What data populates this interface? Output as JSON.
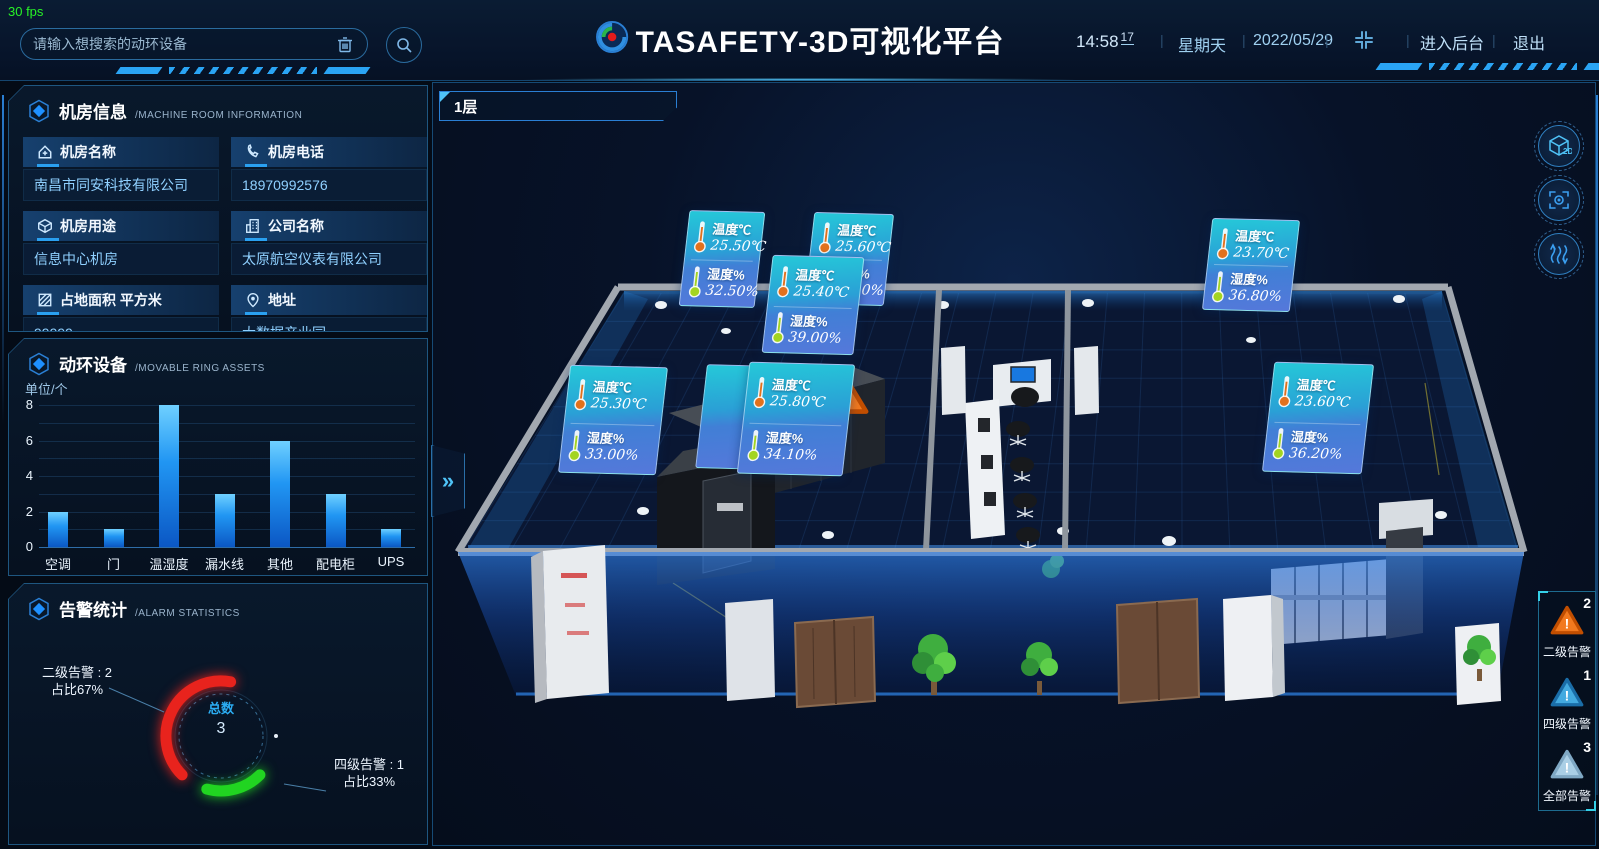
{
  "header": {
    "fps": "30 fps",
    "search": {
      "placeholder": "请输入想搜索的动环设备"
    },
    "title": "TASAFETY-3D可视化平台",
    "clock": {
      "time": "14:58",
      "seconds": "17",
      "weekday": "星期天",
      "date": "2022/05/29"
    },
    "actions": {
      "backend": "进入后台",
      "exit": "退出"
    }
  },
  "panels": {
    "room_info": {
      "title": "机房信息",
      "subtitle": "/MACHINE ROOM INFORMATION",
      "fields": [
        {
          "icon": "home-icon",
          "label": "机房名称",
          "value": "南昌市同安科技有限公司"
        },
        {
          "icon": "phone-icon",
          "label": "机房电话",
          "value": "18970992576"
        },
        {
          "icon": "cube-icon",
          "label": "机房用途",
          "value": "信息中心机房"
        },
        {
          "icon": "building-icon",
          "label": "公司名称",
          "value": "太原航空仪表有限公司"
        },
        {
          "icon": "area-icon",
          "label": "占地面积 平方米",
          "value": "99999"
        },
        {
          "icon": "pin-icon",
          "label": "地址",
          "value": "大数据产业园"
        }
      ]
    },
    "assets": {
      "title": "动环设备",
      "subtitle": "/MOVABLE RING ASSETS",
      "unit": "单位/个"
    },
    "alarms": {
      "title": "告警统计",
      "subtitle": "/ALARM STATISTICS",
      "total_label": "总数",
      "total_value": "3",
      "level2": {
        "label": "二级告警 : 2",
        "pct": "占比67%"
      },
      "level4": {
        "label": "四级告警 : 1",
        "pct": "占比33%"
      }
    }
  },
  "scene": {
    "floor_label": "1层",
    "expand_icon": "»",
    "sensor_labels": {
      "temp": "温度℃",
      "hum": "湿度%"
    },
    "sensors": [
      {
        "temp": "25.50℃",
        "hum": "32.50%"
      },
      {
        "temp": "25.60℃",
        "hum": "34.40%"
      },
      {
        "temp": "25.40℃",
        "hum": "39.00%"
      },
      {
        "temp": "23.70℃",
        "hum": "36.80%"
      },
      {
        "temp": "25.30℃",
        "hum": "33.00%"
      },
      {
        "temp": "25.80℃",
        "hum": "34.10%"
      },
      {
        "temp": "23.60℃",
        "hum": "36.20%"
      }
    ],
    "badges": [
      {
        "count": "2",
        "label": "二级告警",
        "color": "#f2791e",
        "edge": "#c14e00"
      },
      {
        "count": "1",
        "label": "四级告警",
        "color": "#43aae0",
        "edge": "#1a6da8"
      },
      {
        "count": "3",
        "label": "全部告警",
        "color": "#aacfe6",
        "edge": "#7fa8c4"
      }
    ]
  },
  "chart_data": [
    {
      "type": "bar",
      "title": "动环设备/MOVABLE RING ASSETS",
      "categories": [
        "空调",
        "门",
        "温湿度",
        "漏水线",
        "其他",
        "配电柜",
        "UPS"
      ],
      "values": [
        2,
        1,
        8,
        3,
        6,
        3,
        1
      ],
      "xlabel": "",
      "ylabel": "单位/个",
      "ylim": [
        0,
        8
      ],
      "yticks": [
        0,
        2,
        4,
        6,
        8
      ],
      "grid": true,
      "bar_color": "#2196f3"
    },
    {
      "type": "pie",
      "title": "告警统计/ALARM STATISTICS",
      "labels": [
        "二级告警",
        "四级告警"
      ],
      "values": [
        2,
        1
      ],
      "percents": [
        "67%",
        "33%"
      ],
      "colors": [
        "#e8231d",
        "#21d421"
      ],
      "center_label": "总数",
      "center_value": 3
    }
  ]
}
